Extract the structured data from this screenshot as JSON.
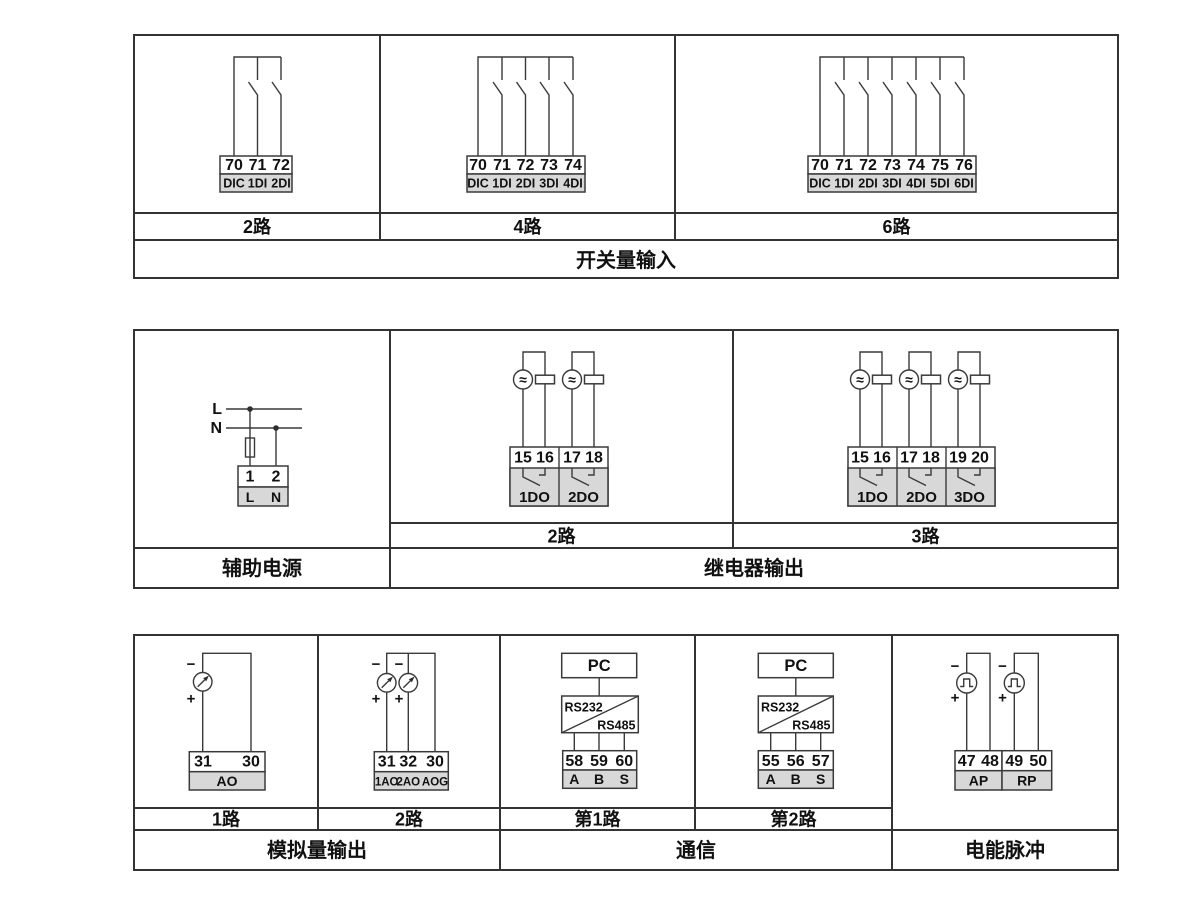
{
  "canvas": {
    "background": "#ffffff",
    "line_color": "#3a3a3a",
    "gray_fill": "#d8d8d8"
  },
  "symbols": {
    "minus": "−",
    "plus": "+",
    "ac": "≈"
  },
  "digital_input": {
    "title": "开关量输入",
    "v2": {
      "label": "2路",
      "t": [
        "70",
        "71",
        "72"
      ],
      "n": [
        "DIC",
        "1DI",
        "2DI"
      ]
    },
    "v4": {
      "label": "4路",
      "t": [
        "70",
        "71",
        "72",
        "73",
        "74"
      ],
      "n": [
        "DIC",
        "1DI",
        "2DI",
        "3DI",
        "4DI"
      ]
    },
    "v6": {
      "label": "6路",
      "t": [
        "70",
        "71",
        "72",
        "73",
        "74",
        "75",
        "76"
      ],
      "n": [
        "DIC",
        "1DI",
        "2DI",
        "3DI",
        "4DI",
        "5DI",
        "6DI"
      ]
    }
  },
  "aux_power": {
    "title": "辅助电源",
    "live": "L",
    "neutral": "N",
    "t": [
      "1",
      "2"
    ],
    "n": [
      "L",
      "N"
    ]
  },
  "relay_output": {
    "title": "继电器输出",
    "v2": {
      "label": "2路",
      "t": [
        "15",
        "16",
        "17",
        "18"
      ],
      "n": [
        "1DO",
        "2DO"
      ]
    },
    "v3": {
      "label": "3路",
      "t": [
        "15",
        "16",
        "17",
        "18",
        "19",
        "20"
      ],
      "n": [
        "1DO",
        "2DO",
        "3DO"
      ]
    }
  },
  "analog_output": {
    "title": "模拟量输出",
    "v1": {
      "label": "1路",
      "t": [
        "31",
        "30"
      ],
      "n": [
        "AO"
      ]
    },
    "v2": {
      "label": "2路",
      "t": [
        "31",
        "32",
        "30"
      ],
      "n": [
        "1AO",
        "2AO",
        "AOG"
      ]
    }
  },
  "communication": {
    "title": "通信",
    "v1": {
      "label": "第1路",
      "pc": "PC",
      "conv": [
        "RS232",
        "RS485"
      ],
      "t": [
        "58",
        "59",
        "60"
      ],
      "n": [
        "A",
        "B",
        "S"
      ]
    },
    "v2": {
      "label": "第2路",
      "pc": "PC",
      "conv": [
        "RS232",
        "RS485"
      ],
      "t": [
        "55",
        "56",
        "57"
      ],
      "n": [
        "A",
        "B",
        "S"
      ]
    }
  },
  "energy_pulse": {
    "title": "电能脉冲",
    "t": [
      "47",
      "48",
      "49",
      "50"
    ],
    "n": [
      "AP",
      "RP"
    ]
  }
}
